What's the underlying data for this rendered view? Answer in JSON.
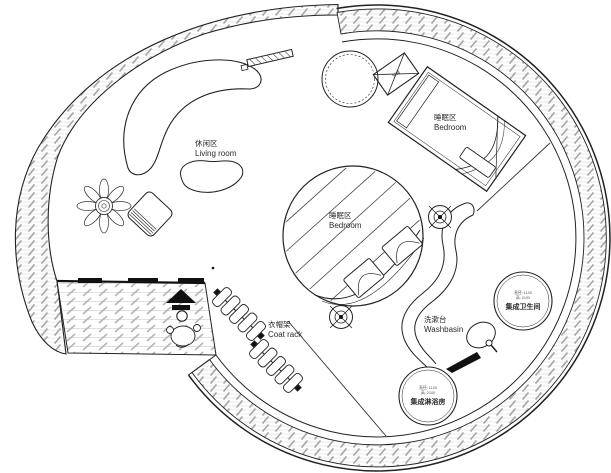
{
  "drawing_title": "圆形小屋平面布置图",
  "colors": {
    "line": "#1a1a1a",
    "hatch": "#a8a8a8",
    "plank": "#d8d8d8",
    "text": "#2b2b2b"
  },
  "labels": {
    "living_room": {
      "zh": "休闲区",
      "en": "Living room"
    },
    "bedroom_upper": {
      "zh": "睡眠区",
      "en": "Bedroom"
    },
    "bedroom_center": {
      "zh": "睡眠区",
      "en": "Bedroom"
    },
    "coat_rack": {
      "zh": "衣帽架",
      "en": "Coat rack"
    },
    "washbasin": {
      "zh": "洗漱台",
      "en": "Washbasin"
    },
    "toilet_pod": {
      "dim1": "直径: 1100",
      "dim2": "高: 2100",
      "name": "集成卫生间"
    },
    "shower_pod": {
      "dim1": "直径: 1100",
      "dim2": "高: 2100",
      "name": "集成淋浴房"
    },
    "ac_unit": "空调"
  },
  "icons": {
    "entrance_arrow": "arrow-up-solid",
    "column_marker": "target-crosshair",
    "faucet": "faucet-dot"
  }
}
